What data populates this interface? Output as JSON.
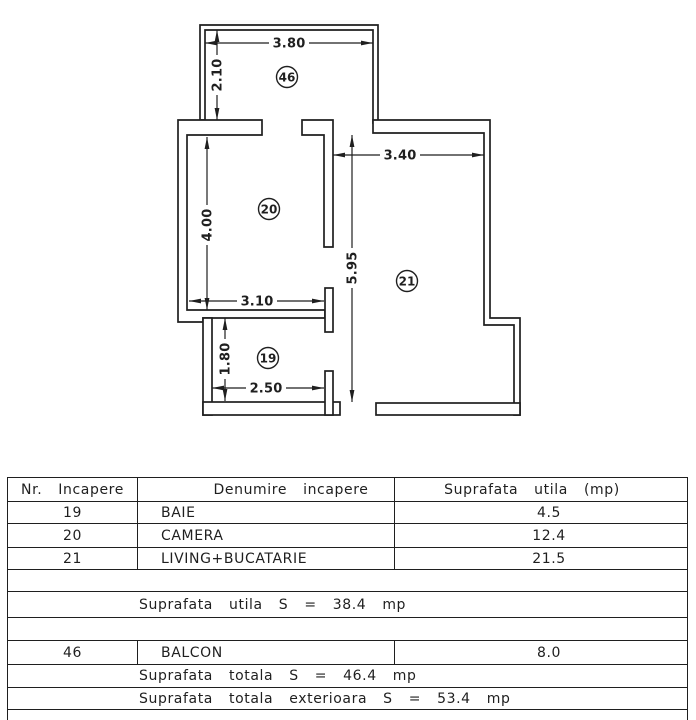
{
  "colors": {
    "ink": "#1f1f1f",
    "paper": "#ffffff"
  },
  "plan": {
    "dimensions": {
      "balcony_width": "3.80",
      "balcony_depth": "2.10",
      "living_width": "3.40",
      "camera_height": "4.00",
      "living_height": "5.95",
      "camera_width": "3.10",
      "bath_height": "1.80",
      "bath_width": "2.50"
    },
    "room_numbers": {
      "balcony": "46",
      "camera": "20",
      "living": "21",
      "bath": "19"
    }
  },
  "table": {
    "headers": {
      "nr": "Nr. Incapere",
      "name": "Denumire incapere",
      "area": "Suprafata utila (mp)"
    },
    "rows": [
      {
        "nr": "19",
        "name": "BAIE",
        "area": "4.5"
      },
      {
        "nr": "20",
        "name": "CAMERA",
        "area": "12.4"
      },
      {
        "nr": "21",
        "name": "LIVING+BUCATARIE",
        "area": "21.5"
      }
    ],
    "subtotal": "Suprafata utila S = 38.4 mp",
    "balcony_row": {
      "nr": "46",
      "name": "BALCON",
      "area": "8.0"
    },
    "total": "Suprafata totala S = 46.4 mp",
    "total_exterior": "Suprafata totala exterioara S = 53.4 mp"
  }
}
